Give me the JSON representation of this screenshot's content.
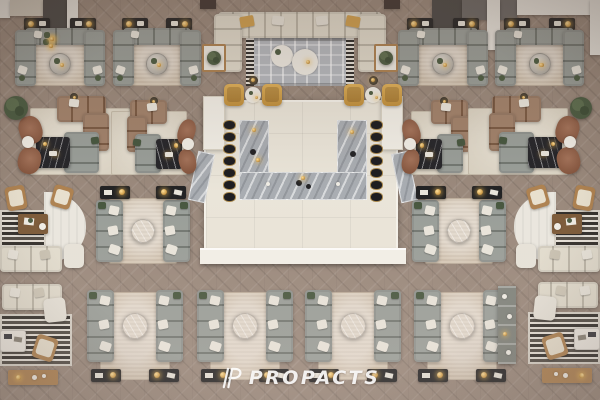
{
  "meta": {
    "description": "Top-down 3D architectural render of a furniture showroom lounge floor",
    "width": 600,
    "height": 400
  },
  "watermark": {
    "brand": "PROPACTS",
    "icon": "propacts-p-logo"
  },
  "palette": {
    "floor": "#9a897c",
    "rug_beige": "#d4c6b3",
    "rug_cream": "#e2dac9",
    "rug_gray": "#b6bac0",
    "rug_white": "#eae7df",
    "sofa_gray": "#868c85",
    "sofa_cream": "#ddd6c5",
    "sofa_brown": "#8f6a4f",
    "chair_brown": "#8a5b41",
    "chair_yellow": "#d2a14e",
    "wood": "#ae8251",
    "wood_dark": "#7c5a38",
    "marble_light": "#c9c5bd",
    "marble_gray": "#a9adb2",
    "marble_black": "#26262a",
    "platform": "#eae5d9",
    "pillar": "#f1eee6",
    "ledge": "#f3f0e8",
    "wall_dark": "#4a4846",
    "wall_gray": "#6b6866",
    "wall_white": "#e9e6df",
    "wall_beige": "#cfc8bb",
    "wall_brown": "#3f3531",
    "gold": "#d2a14e",
    "gold_light": "#ffe09a",
    "stool_black": "#1d1d20",
    "console_black": "#232324",
    "plant_green": "#4c5c42",
    "stripe_dark": "#33302c",
    "stripe_light": "#e6e2da",
    "pillow_white": "#e9e5db",
    "pillow_green": "#47573f"
  },
  "scene": {
    "walls": [
      {
        "name": "wall-white-left",
        "x": 0,
        "y": 0,
        "w": 10,
        "h": 18,
        "c": "wall_white"
      },
      {
        "name": "wall-beige-left",
        "x": 10,
        "y": 0,
        "w": 33,
        "h": 16,
        "c": "wall_beige"
      },
      {
        "name": "wall-dark-left",
        "x": 43,
        "y": 0,
        "w": 24,
        "h": 28,
        "c": "wall_dark"
      },
      {
        "name": "wall-column-left",
        "x": 67,
        "y": 0,
        "w": 11,
        "h": 38,
        "c": "wall_white"
      },
      {
        "name": "wall-brown-left",
        "x": 200,
        "y": 0,
        "w": 16,
        "h": 9,
        "c": "wall_brown"
      },
      {
        "name": "wall-brown-right",
        "x": 384,
        "y": 0,
        "w": 16,
        "h": 9,
        "c": "wall_brown"
      },
      {
        "name": "wall-dark-right",
        "x": 432,
        "y": 0,
        "w": 30,
        "h": 28,
        "c": "wall_dark"
      },
      {
        "name": "wall-gray-right",
        "x": 462,
        "y": 0,
        "w": 55,
        "h": 20,
        "c": "wall_gray"
      },
      {
        "name": "wall-column-mid-right",
        "x": 487,
        "y": 0,
        "w": 13,
        "h": 50,
        "c": "wall_white"
      },
      {
        "name": "wall-white-right",
        "x": 517,
        "y": 0,
        "w": 83,
        "h": 15,
        "c": "wall_white"
      },
      {
        "name": "wall-column-far-right",
        "x": 590,
        "y": 0,
        "w": 10,
        "h": 55,
        "c": "wall_white"
      }
    ],
    "groups": [
      {
        "type": "platform",
        "id": "bar-platform",
        "x": 204,
        "y": 100,
        "w": 194,
        "h": 162
      },
      {
        "type": "u-sofa",
        "id": "u1",
        "x": 14,
        "y": 24,
        "w": 92,
        "h": 66
      },
      {
        "type": "u-sofa",
        "id": "u2",
        "x": 112,
        "y": 24,
        "w": 90,
        "h": 66
      },
      {
        "type": "u-sofa",
        "id": "u3",
        "x": 397,
        "y": 24,
        "w": 92,
        "h": 66
      },
      {
        "type": "u-sofa",
        "id": "u4",
        "x": 494,
        "y": 24,
        "w": 91,
        "h": 66
      },
      {
        "type": "cream-sectional",
        "id": "cs",
        "x": 202,
        "y": 6,
        "w": 196,
        "h": 86
      },
      {
        "type": "armchair-pair",
        "id": "p1",
        "x": 224,
        "y": 76,
        "w": 58,
        "h": 32
      },
      {
        "type": "armchair-pair",
        "id": "p2",
        "x": 344,
        "y": 76,
        "w": 58,
        "h": 32
      },
      {
        "type": "lounge",
        "id": "l1",
        "x": 18,
        "y": 94,
        "w": 122,
        "h": 86,
        "mirror": false
      },
      {
        "type": "lounge",
        "id": "l2",
        "x": 104,
        "y": 98,
        "w": 92,
        "h": 82,
        "mirror": true
      },
      {
        "type": "lounge",
        "id": "l3",
        "x": 402,
        "y": 98,
        "w": 92,
        "h": 82,
        "mirror": false
      },
      {
        "type": "lounge",
        "id": "l4",
        "x": 458,
        "y": 94,
        "w": 122,
        "h": 86,
        "mirror": true
      },
      {
        "type": "plant",
        "id": "plant-left",
        "x": 4,
        "y": 92,
        "w": 24,
        "h": 32
      },
      {
        "type": "plant",
        "id": "plant-right",
        "x": 570,
        "y": 94,
        "w": 22,
        "h": 28
      },
      {
        "type": "facing-sofa",
        "id": "c0",
        "x": 94,
        "y": 186,
        "w": 98,
        "h": 82,
        "lamps": "top"
      },
      {
        "type": "facing-sofa",
        "id": "c1",
        "x": 410,
        "y": 186,
        "w": 98,
        "h": 82,
        "lamps": "top"
      },
      {
        "type": "reading-corner",
        "id": "b1",
        "x": 0,
        "y": 186,
        "w": 86,
        "h": 88,
        "mirror": false
      },
      {
        "type": "reading-corner",
        "id": "e1",
        "x": 514,
        "y": 186,
        "w": 86,
        "h": 88,
        "mirror": true
      },
      {
        "type": "facing-sofa",
        "id": "d1",
        "x": 85,
        "y": 288,
        "w": 100,
        "h": 97,
        "lamps": "bottom"
      },
      {
        "type": "facing-sofa",
        "id": "d2",
        "x": 195,
        "y": 288,
        "w": 100,
        "h": 97,
        "lamps": "bottom"
      },
      {
        "type": "facing-sofa",
        "id": "d3",
        "x": 303,
        "y": 288,
        "w": 100,
        "h": 97,
        "lamps": "bottom"
      },
      {
        "type": "facing-sofa",
        "id": "d4",
        "x": 412,
        "y": 288,
        "w": 100,
        "h": 97,
        "lamps": "bottom"
      },
      {
        "type": "bench-corner",
        "id": "b2",
        "x": 0,
        "y": 278,
        "w": 76,
        "h": 116,
        "mirror": false
      },
      {
        "type": "shelf",
        "id": "bookshelf",
        "x": 498,
        "y": 286,
        "w": 18,
        "h": 78
      },
      {
        "type": "bench-corner",
        "id": "e2",
        "x": 524,
        "y": 276,
        "w": 76,
        "h": 118,
        "mirror": true
      }
    ]
  }
}
